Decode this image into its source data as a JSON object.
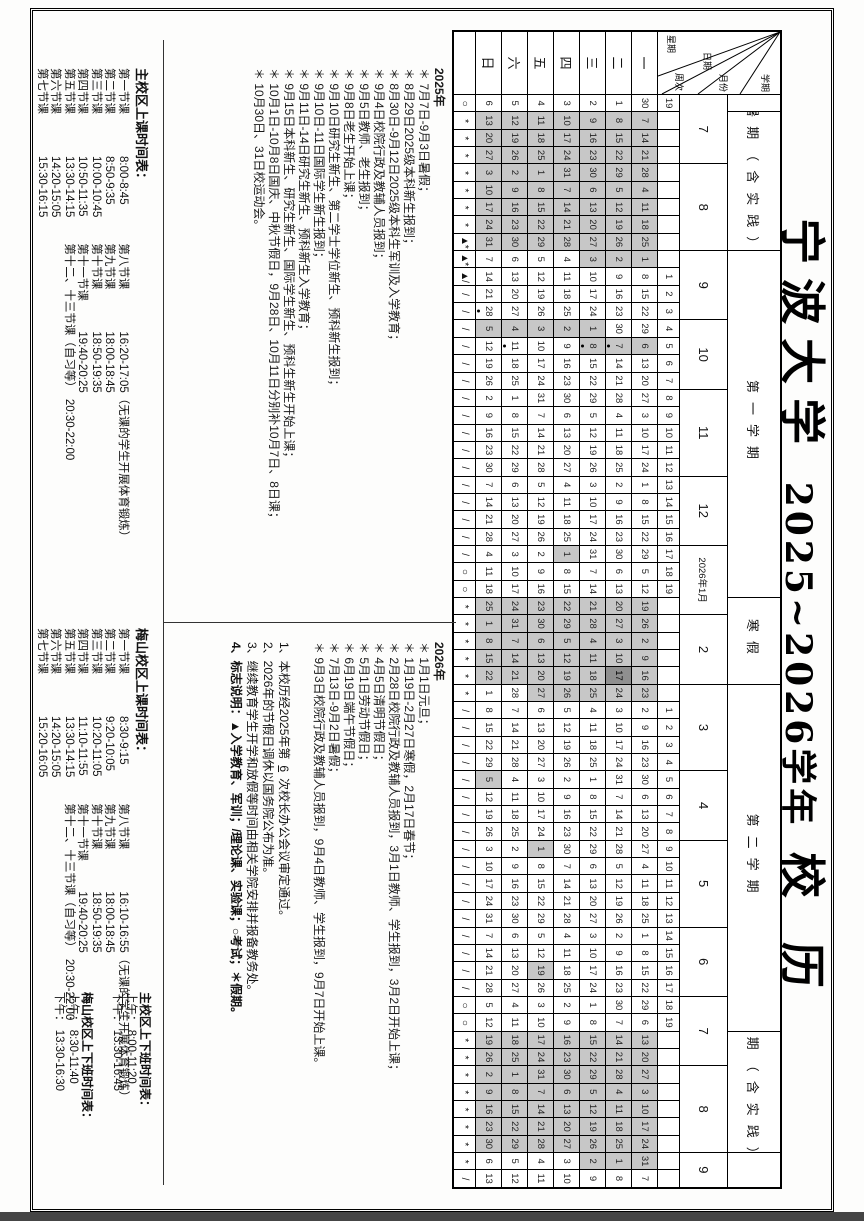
{
  "page": {
    "title_part1": "宁波大学",
    "title_part2": "2025~2026学年",
    "title_part3": "校  历"
  },
  "corner": {
    "semester_label": "学期",
    "month_label": "月份",
    "date_label": "日期",
    "weekno_label": "周次",
    "weekday_label": "星期"
  },
  "calendar": {
    "colors": {
      "vacation_bg": "#c7c7c7",
      "festival_bg": "#8f8f8f",
      "grid_line": "#000000"
    },
    "weekday_labels": [
      "一",
      "二",
      "三",
      "四",
      "五",
      "六",
      "日"
    ],
    "semesters": [
      {
        "label": "",
        "span": 1
      },
      {
        "label": "暑期（含实践）",
        "span": 8
      },
      {
        "label": "第一学期",
        "span": 20
      },
      {
        "label": "寒假",
        "span": 5
      },
      {
        "label": "第二学期",
        "span": 20
      },
      {
        "label": "暑期（含实践）",
        "span": 7
      },
      {
        "label": "",
        "span": 2
      }
    ],
    "months": [
      {
        "label": "7",
        "span": 4
      },
      {
        "label": "8",
        "span": 5
      },
      {
        "label": "9",
        "span": 4
      },
      {
        "label": "10",
        "span": 4
      },
      {
        "label": "11",
        "span": 5
      },
      {
        "label": "12",
        "span": 4
      },
      {
        "label": "2026年1月",
        "span": 4
      },
      {
        "label": "2",
        "span": 4
      },
      {
        "label": "3",
        "span": 5
      },
      {
        "label": "4",
        "span": 4
      },
      {
        "label": "5",
        "span": 5
      },
      {
        "label": "6",
        "span": 4
      },
      {
        "label": "7",
        "span": 4
      },
      {
        "label": "8",
        "span": 5
      },
      {
        "label": "9",
        "span": 2
      }
    ],
    "weeks": [
      {
        "w": "19",
        "y": "○",
        "d": [
          30,
          1,
          2,
          3,
          4,
          5,
          6
        ]
      },
      {
        "y": "*",
        "d": [
          7,
          8,
          9,
          10,
          11,
          12,
          13
        ],
        "s": "1111111"
      },
      {
        "y": "*",
        "d": [
          14,
          15,
          16,
          17,
          18,
          19,
          20
        ],
        "s": "1111111"
      },
      {
        "y": "*",
        "d": [
          21,
          22,
          23,
          24,
          25,
          26,
          27
        ],
        "s": "1111111"
      },
      {
        "y": "*",
        "d": [
          28,
          29,
          30,
          31,
          1,
          2,
          3
        ],
        "s": "1111111"
      },
      {
        "y": "*",
        "d": [
          4,
          5,
          6,
          7,
          8,
          9,
          10
        ],
        "s": "1111111"
      },
      {
        "y": "*",
        "d": [
          11,
          12,
          13,
          14,
          15,
          16,
          17
        ],
        "s": "1111111"
      },
      {
        "y": "*",
        "d": [
          18,
          19,
          20,
          21,
          22,
          23,
          24
        ],
        "s": "1111111"
      },
      {
        "y": "▲*",
        "d": [
          25,
          26,
          27,
          28,
          29,
          30,
          31
        ],
        "s": "1111111"
      },
      {
        "y": "▲*",
        "d": [
          1,
          2,
          3,
          4,
          5,
          6,
          7
        ],
        "s": "1110000"
      },
      {
        "w": "1",
        "y": "▲/",
        "d": [
          8,
          9,
          10,
          11,
          12,
          13,
          14
        ]
      },
      {
        "w": "2",
        "y": "/",
        "d": [
          15,
          16,
          17,
          18,
          19,
          20,
          21
        ]
      },
      {
        "w": "3",
        "y": "/",
        "d": [
          22,
          23,
          24,
          25,
          26,
          27,
          28
        ],
        "o": [
          6
        ]
      },
      {
        "w": "4",
        "y": "/",
        "d": [
          29,
          30,
          1,
          2,
          3,
          4,
          5
        ],
        "s": "0011111"
      },
      {
        "w": "5",
        "y": "/",
        "d": [
          6,
          7,
          8,
          9,
          10,
          11,
          12
        ],
        "s": "1110000",
        "o": [
          1,
          2,
          5
        ]
      },
      {
        "w": "6",
        "y": "/",
        "d": [
          13,
          14,
          15,
          16,
          17,
          18,
          19
        ]
      },
      {
        "w": "7",
        "y": "/",
        "d": [
          20,
          21,
          22,
          23,
          24,
          25,
          26
        ]
      },
      {
        "w": "8",
        "y": "/",
        "d": [
          27,
          28,
          29,
          30,
          31,
          1,
          2
        ]
      },
      {
        "w": "9",
        "y": "/",
        "d": [
          3,
          4,
          5,
          6,
          7,
          8,
          9
        ]
      },
      {
        "w": "10",
        "y": "/",
        "d": [
          10,
          11,
          12,
          13,
          14,
          15,
          16
        ]
      },
      {
        "w": "11",
        "y": "/",
        "d": [
          17,
          18,
          19,
          20,
          21,
          22,
          23
        ]
      },
      {
        "w": "12",
        "y": "/",
        "d": [
          24,
          25,
          26,
          27,
          28,
          29,
          30
        ]
      },
      {
        "w": "13",
        "y": "/",
        "d": [
          1,
          2,
          3,
          4,
          5,
          6,
          7
        ]
      },
      {
        "w": "14",
        "y": "/",
        "d": [
          8,
          9,
          10,
          11,
          12,
          13,
          14
        ]
      },
      {
        "w": "15",
        "y": "/",
        "d": [
          15,
          16,
          17,
          18,
          19,
          20,
          21
        ]
      },
      {
        "w": "16",
        "y": "/",
        "d": [
          22,
          23,
          24,
          25,
          26,
          27,
          28
        ]
      },
      {
        "w": "17",
        "y": "/",
        "d": [
          29,
          30,
          31,
          1,
          2,
          3,
          4
        ],
        "s": "0001000"
      },
      {
        "w": "18",
        "y": "○",
        "d": [
          5,
          6,
          7,
          8,
          9,
          10,
          11
        ]
      },
      {
        "w": "19",
        "y": "○",
        "d": [
          12,
          13,
          14,
          15,
          16,
          17,
          18
        ]
      },
      {
        "y": "*",
        "d": [
          19,
          20,
          21,
          22,
          23,
          24,
          25
        ],
        "s": "1111111"
      },
      {
        "y": "*",
        "d": [
          26,
          27,
          28,
          29,
          30,
          31,
          1
        ],
        "s": "1111111"
      },
      {
        "y": "*",
        "d": [
          2,
          3,
          4,
          5,
          6,
          7,
          8
        ],
        "s": "1111111"
      },
      {
        "y": "*",
        "d": [
          9,
          10,
          11,
          12,
          13,
          14,
          15
        ],
        "s": "1111111"
      },
      {
        "y": "*",
        "d": [
          16,
          17,
          18,
          19,
          20,
          21,
          22
        ],
        "s": "1211111"
      },
      {
        "y": "*",
        "d": [
          23,
          24,
          25,
          26,
          27,
          28,
          1
        ],
        "s": "1111100"
      },
      {
        "w": "1",
        "y": "/",
        "d": [
          2,
          3,
          4,
          5,
          6,
          7,
          8
        ]
      },
      {
        "w": "2",
        "y": "/",
        "d": [
          9,
          10,
          11,
          12,
          13,
          14,
          15
        ]
      },
      {
        "w": "3",
        "y": "/",
        "d": [
          16,
          17,
          18,
          19,
          20,
          21,
          22
        ]
      },
      {
        "w": "4",
        "y": "/",
        "d": [
          23,
          24,
          25,
          26,
          27,
          28,
          29
        ]
      },
      {
        "w": "5",
        "y": "/",
        "d": [
          30,
          31,
          1,
          2,
          3,
          4,
          5
        ],
        "s": "0000001"
      },
      {
        "w": "6",
        "y": "/",
        "d": [
          6,
          7,
          8,
          9,
          10,
          11,
          12
        ]
      },
      {
        "w": "7",
        "y": "/",
        "d": [
          13,
          14,
          15,
          16,
          17,
          18,
          19
        ]
      },
      {
        "w": "8",
        "y": "/",
        "d": [
          20,
          21,
          22,
          23,
          24,
          25,
          26
        ]
      },
      {
        "w": "9",
        "y": "/",
        "d": [
          27,
          28,
          29,
          30,
          1,
          2,
          3
        ],
        "s": "0000100"
      },
      {
        "w": "10",
        "y": "/",
        "d": [
          4,
          5,
          6,
          7,
          8,
          9,
          10
        ]
      },
      {
        "w": "11",
        "y": "/",
        "d": [
          11,
          12,
          13,
          14,
          15,
          16,
          17
        ]
      },
      {
        "w": "12",
        "y": "/",
        "d": [
          18,
          19,
          20,
          21,
          22,
          23,
          24
        ]
      },
      {
        "w": "13",
        "y": "/",
        "d": [
          25,
          26,
          27,
          28,
          29,
          30,
          31
        ]
      },
      {
        "w": "14",
        "y": "/",
        "d": [
          1,
          2,
          3,
          4,
          5,
          6,
          7
        ]
      },
      {
        "w": "15",
        "y": "/",
        "d": [
          8,
          9,
          10,
          11,
          12,
          13,
          14
        ]
      },
      {
        "w": "16",
        "y": "/",
        "d": [
          15,
          16,
          17,
          18,
          19,
          20,
          21
        ],
        "s": "0000100"
      },
      {
        "w": "17",
        "y": "/",
        "d": [
          22,
          23,
          24,
          25,
          26,
          27,
          28
        ]
      },
      {
        "w": "18",
        "y": "○",
        "d": [
          29,
          30,
          1,
          2,
          3,
          4,
          5
        ]
      },
      {
        "w": "19",
        "y": "○",
        "d": [
          6,
          7,
          8,
          9,
          10,
          11,
          12
        ]
      },
      {
        "y": "*",
        "d": [
          13,
          14,
          15,
          16,
          17,
          18,
          19
        ],
        "s": "1111111"
      },
      {
        "y": "*",
        "d": [
          20,
          21,
          22,
          23,
          24,
          25,
          26
        ],
        "s": "1111111"
      },
      {
        "y": "*",
        "d": [
          27,
          28,
          29,
          30,
          31,
          1,
          2
        ],
        "s": "1111111"
      },
      {
        "y": "*",
        "d": [
          3,
          4,
          5,
          6,
          7,
          8,
          9
        ],
        "s": "1111111"
      },
      {
        "y": "*",
        "d": [
          10,
          11,
          12,
          13,
          14,
          15,
          16
        ],
        "s": "1111111"
      },
      {
        "y": "*",
        "d": [
          17,
          18,
          19,
          20,
          21,
          22,
          23
        ],
        "s": "1111111"
      },
      {
        "y": "*",
        "d": [
          24,
          25,
          26,
          27,
          28,
          29,
          30
        ],
        "s": "1111111"
      },
      {
        "y": "*",
        "d": [
          31,
          1,
          2,
          3,
          4,
          5,
          6
        ],
        "s": "1110000"
      },
      {
        "y": "/",
        "d": [
          7,
          8,
          9,
          10,
          11,
          12,
          13
        ]
      }
    ]
  },
  "notes_2025": {
    "year": "2025年",
    "items": [
      "＊ 7月7日-9月3日暑假；",
      "＊ 8月29日2025级本科新生报到；",
      "＊ 8月30日-9月12日2025级本科生军训及入学教育；",
      "＊ 9月4日校院行政及教辅人员报到；",
      "＊ 9月5日教师、老生报到；",
      "＊ 9月8日老生开始上课；",
      "＊ 9月10日研究生新生、第二学士学位新生、预科新生报到；",
      "＊ 9月10日-11日国际学生新生报到；",
      "＊ 9月11日-14日研究生新生、预科新生入学教育；",
      "＊ 9月15日本科新生、研究生新生、国际学生新生、预科生新生开始上课；",
      "＊ 10月1日-10月8日国庆、中秋节假日，9月28日、10月11日分别补10月7日、8日课；",
      "＊ 10月30日、31日校运动会。"
    ]
  },
  "notes_2026": {
    "year": "2026年",
    "items": [
      "＊ 1月1日元旦；",
      "＊ 1月19日-2月27日寒假，2月17日春节；",
      "＊ 2月28日校院行政及教辅人员报到，3月1日教师、学生报到，3月2日开始上课；",
      "＊ 4月5日清明节假日；",
      "＊ 5月1日劳动节假日；",
      "＊ 6月19日端午节假日；",
      "＊ 7月13日-9月2日暑假；",
      "＊ 9月3日校院行政及教辅人员报到，9月4日教师、学生报到，9月7日开始上课。"
    ]
  },
  "general_notes": {
    "approval_pre": "1、本校历经2025年第",
    "approval_num": "6",
    "approval_post": "次校长办公会议审定通过。",
    "items": [
      "2、2026年的节假日调休以国务院公布为准。",
      "3、继续教育学生开学和放假等时间由相关学院安排并报备教务处。"
    ],
    "legend_label": "4、标志说明：",
    "legend_text": "▲入学教育、军训；/理论课、实验课；○考试；＊假期。"
  },
  "timetables": {
    "main": {
      "title": "主校区上课时间表：",
      "col1": [
        [
          "第一节课",
          "8:00-8:45"
        ],
        [
          "第二节课",
          "8:50-9:35"
        ],
        [
          "第三节课",
          "10:00-10:45"
        ],
        [
          "第四节课",
          "10:50-11:35"
        ],
        [
          "第五节课",
          "13:30-14:15"
        ],
        [
          "第六节课",
          "14:20-15:05"
        ],
        [
          "第七节课",
          "15:30-16:15"
        ]
      ],
      "col2": [
        [
          "第八节课",
          "16:20-17:05",
          "（无课的学生开展体育锻炼）"
        ],
        [
          "第九节课",
          "18:00-18:45"
        ],
        [
          "第十节课",
          "18:50-19:35"
        ],
        [
          "第十一节课",
          "19:40-20:25"
        ],
        [
          "第十二、十三节课（自习等）",
          "20:30-22:00"
        ]
      ]
    },
    "meishan": {
      "title": "梅山校区上课时间表：",
      "col1": [
        [
          "第一节课",
          "8:30-9:15"
        ],
        [
          "第二节课",
          "9:20-10:05"
        ],
        [
          "第三节课",
          "10:20-11:05"
        ],
        [
          "第四节课",
          "11:10-11:55"
        ],
        [
          "第五节课",
          "13:30-14:15"
        ],
        [
          "第六节课",
          "14:20-15:05"
        ],
        [
          "第七节课",
          "15:20-16:05"
        ]
      ],
      "col2": [
        [
          "第八节课",
          "16:10-16:55",
          "（无课的学生开展体育锻炼）"
        ],
        [
          "第九节课",
          "18:00-18:45"
        ],
        [
          "第十节课",
          "18:50-19:35"
        ],
        [
          "第十一节课",
          "19:40-20:25"
        ],
        [
          "第十二、十三节课（自习等）",
          "20:30-22:00"
        ]
      ]
    },
    "work_main": {
      "title": "主校区上下班时间表：",
      "rows": [
        [
          "上午：",
          "8:00-11:20"
        ],
        [
          "下午：",
          "13:30-16:45"
        ]
      ]
    },
    "work_meishan": {
      "title": "梅山校区上下班时间表：",
      "rows": [
        [
          "上午：",
          "8:30-11:40"
        ],
        [
          "下午：",
          "13:30-16:30"
        ]
      ]
    }
  }
}
